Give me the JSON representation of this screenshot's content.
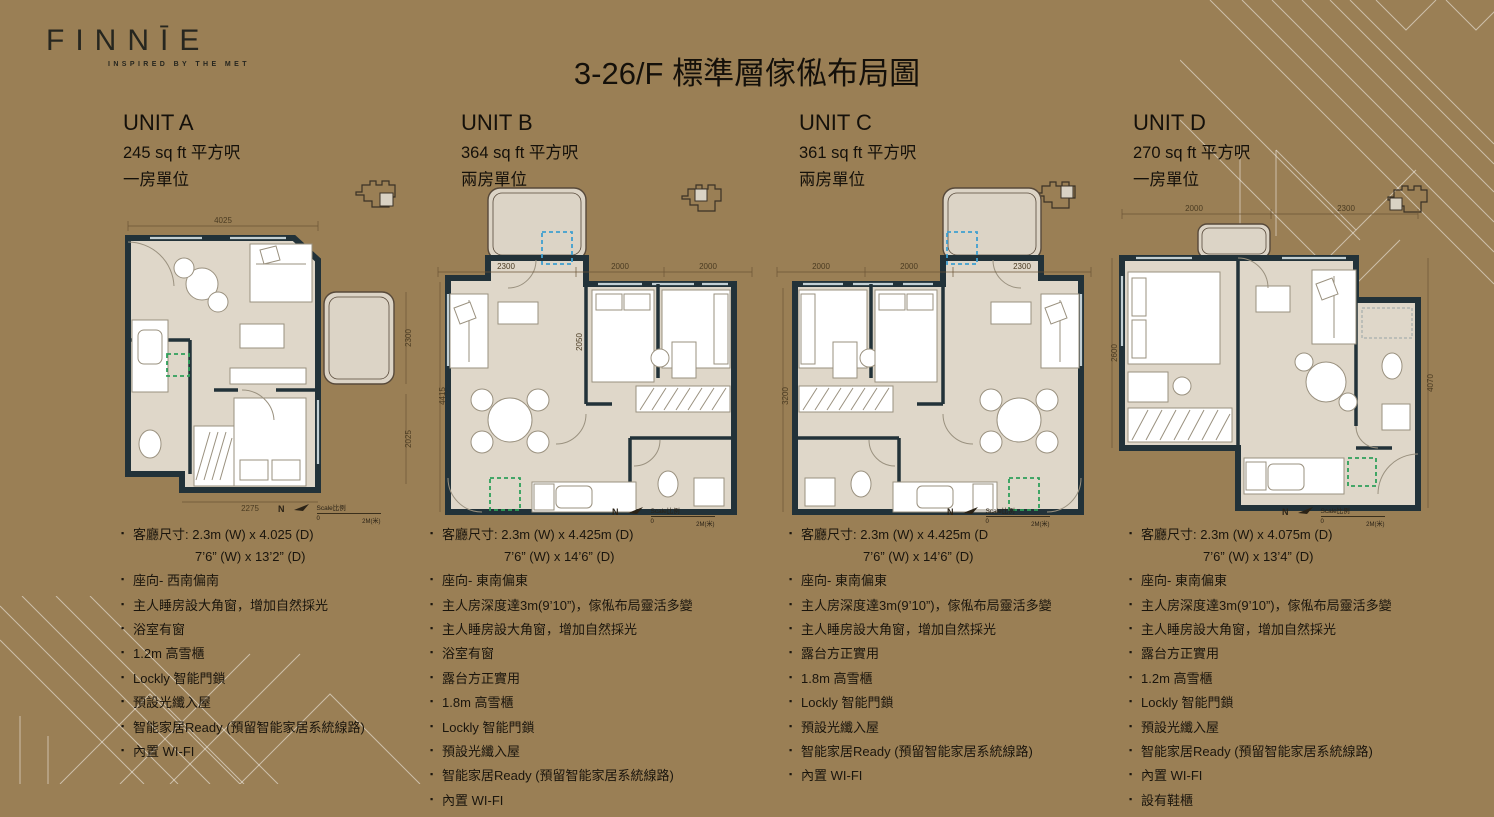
{
  "page": {
    "title": "3-26/F 標準層傢俬布局圖",
    "background": "#9A7F55"
  },
  "logo": {
    "name": "FINNĪE",
    "tagline": "INSPIRED BY THE MET"
  },
  "colors": {
    "background": "#9A7F55",
    "wall": "#223239",
    "floor": "#DFD7C9",
    "green_box": "#2FA05A",
    "blue_box": "#3F9FD0"
  },
  "plan_legend": {
    "north_label": "N",
    "scale_label": "Scale比例",
    "scale_start": "0",
    "scale_end": "2M(米)"
  },
  "units": [
    {
      "id": "A",
      "name": "UNIT A",
      "area": "245 sq ft 平方呎",
      "type": "一房單位",
      "dims": {
        "top": "4025",
        "right_upper": "2300",
        "right_lower": "2025",
        "bottom": "2275"
      },
      "features": [
        {
          "text": "客廳尺寸: 2.3m (W) x 4.025 (D)",
          "sub": "7’6” (W) x 13’2” (D)"
        },
        "座向- 西南偏南",
        "主人睡房設大角窗，增加自然採光",
        "浴室有窗",
        "1.2m 高雪櫃",
        "Lockly 智能門鎖",
        "預設光纖入屋",
        "智能家居Ready (預留智能家居系統線路)",
        "內置 WI-FI"
      ]
    },
    {
      "id": "B",
      "name": "UNIT B",
      "area": "364 sq ft 平方呎",
      "type": "兩房單位",
      "dims": {
        "top_left": "2300",
        "top_mid": "2000",
        "top_right": "2000",
        "left": "4415",
        "inner": "2050"
      },
      "features": [
        {
          "text": "客廳尺寸: 2.3m (W) x 4.425m (D)",
          "sub": "7’6” (W) x 14’6” (D)"
        },
        "座向- 東南偏東",
        "主人房深度達3m(9’10”)，傢俬布局靈活多變",
        "主人睡房設大角窗，增加自然採光",
        "浴室有窗",
        "露台方正實用",
        "1.8m 高雪櫃",
        "Lockly 智能門鎖",
        "預設光纖入屋",
        "智能家居Ready (預留智能家居系統線路)",
        "內置 WI-FI"
      ]
    },
    {
      "id": "C",
      "name": "UNIT C",
      "area": "361 sq ft 平方呎",
      "type": "兩房單位",
      "dims": {
        "top_left": "2000",
        "top_mid": "2000",
        "top_right": "2300",
        "left": "3200"
      },
      "features": [
        {
          "text": "客廳尺寸: 2.3m (W) x 4.425m (D",
          "sub": "7’6” (W) x 14’6” (D)"
        },
        "座向- 東南偏東",
        "主人房深度達3m(9’10”)，傢俬布局靈活多變",
        "主人睡房設大角窗，增加自然採光",
        "露台方正實用",
        "1.8m 高雪櫃",
        "Lockly 智能門鎖",
        "預設光纖入屋",
        "智能家居Ready (預留智能家居系統線路)",
        "內置 WI-FI"
      ]
    },
    {
      "id": "D",
      "name": "UNIT D",
      "area": "270 sq ft 平方呎",
      "type": "一房單位",
      "dims": {
        "top_left": "2000",
        "top_right": "2300",
        "left": "2600",
        "right": "4070"
      },
      "features": [
        {
          "text": "客廳尺寸: 2.3m (W) x 4.075m (D)",
          "sub": "7’6” (W) x 13’4” (D)"
        },
        "座向- 東南偏東",
        "主人房深度達3m(9’10”)，傢俬布局靈活多變",
        "主人睡房設大角窗，增加自然採光",
        "露台方正實用",
        "1.2m 高雪櫃",
        "Lockly 智能門鎖",
        "預設光纖入屋",
        "智能家居Ready (預留智能家居系統線路)",
        "內置 WI-FI",
        "設有鞋櫃"
      ]
    }
  ]
}
